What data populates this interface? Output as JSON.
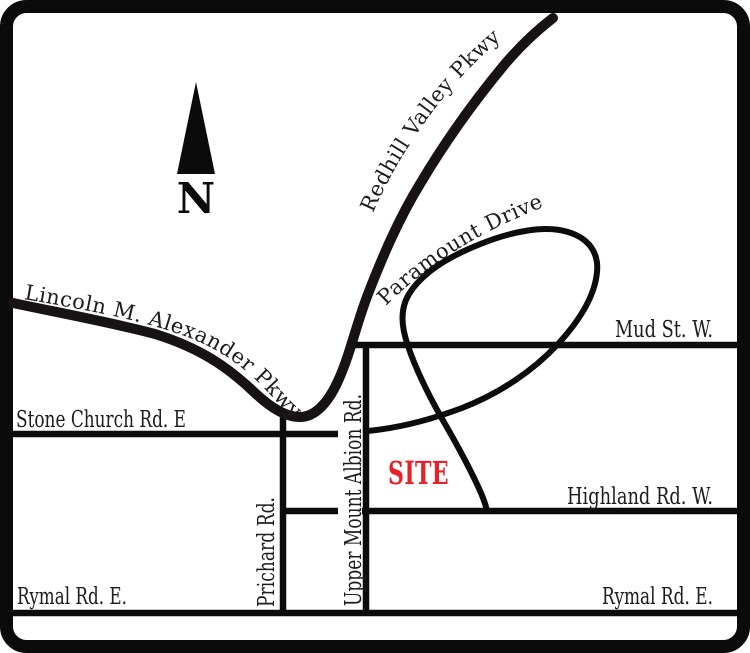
{
  "compass": {
    "letter": "N"
  },
  "site": {
    "label": "SITE",
    "color": "#e62129"
  },
  "roads": {
    "lincoln_alexander": "Lincoln M. Alexander Pkwy",
    "redhill_valley": "Redhill Valley Pkwy",
    "paramount": "Paramount Drive",
    "mud_st": "Mud St. W.",
    "stone_church": "Stone Church Rd. E",
    "highland": "Highland Rd. W.",
    "rymal_left": "Rymal Rd. E.",
    "rymal_right": "Rymal Rd. E.",
    "prichard": "Prichard Rd.",
    "upper_mount_albion": "Upper Mount Albion Rd."
  },
  "colors": {
    "road": "#0c0c0c",
    "text": "#1d1b1c",
    "site": "#e62129",
    "border": "#0b0b0b",
    "background": "#ffffff"
  }
}
